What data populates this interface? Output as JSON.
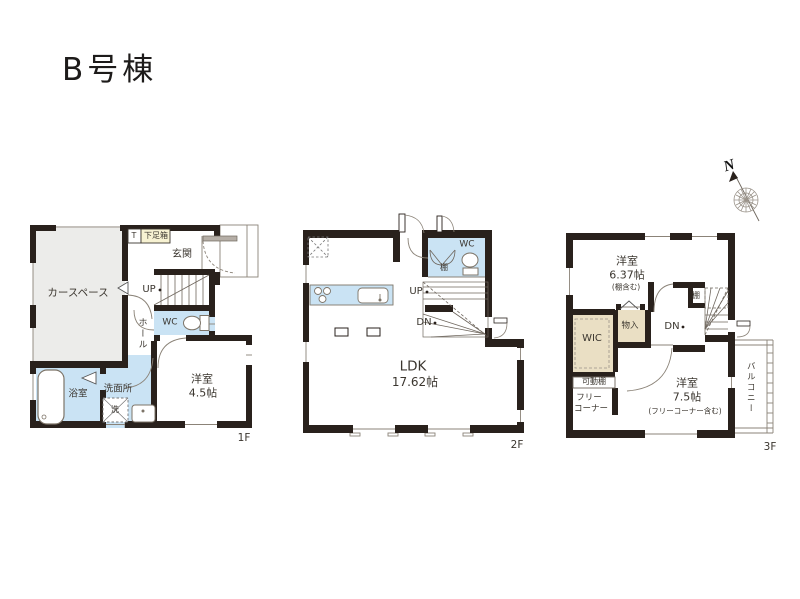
{
  "title": "B号棟",
  "compass": {
    "north": "N"
  },
  "floor1": {
    "tag": "1F",
    "car_space": "カースペース",
    "shoe_t": "T",
    "shoe_box": "下足箱",
    "entrance": "玄関",
    "up": "UP",
    "hall": "ホール",
    "wc": "WC",
    "room_name": "洋室",
    "room_size": "4.5帖",
    "bath": "浴室",
    "washroom": "洗面所",
    "washer": "洗"
  },
  "floor2": {
    "tag": "2F",
    "wc": "WC",
    "shelf": "棚",
    "up": "UP",
    "down": "DN",
    "ldk_name": "LDK",
    "ldk_size": "17.62帖"
  },
  "floor3": {
    "tag": "3F",
    "room1_name": "洋室",
    "room1_size": "6.37帖",
    "room1_note": "(棚含む)",
    "shelf": "棚",
    "down": "DN",
    "closet": "物入",
    "wic": "WIC",
    "movable_shelf": "可動棚",
    "free_corner_1": "フリー",
    "free_corner_2": "コーナー",
    "room2_name": "洋室",
    "room2_size": "7.5帖",
    "room2_note": "(フリーコーナー含む)",
    "balcony": "バルコニー"
  },
  "colors": {
    "wall": "#29211c",
    "wet_area": "#cae3f4",
    "car_space": "#ececea",
    "storage": "#eadfc4",
    "shoe_box": "#f7f2d2",
    "thin_line": "#8b8378",
    "text": "#3b362f"
  }
}
